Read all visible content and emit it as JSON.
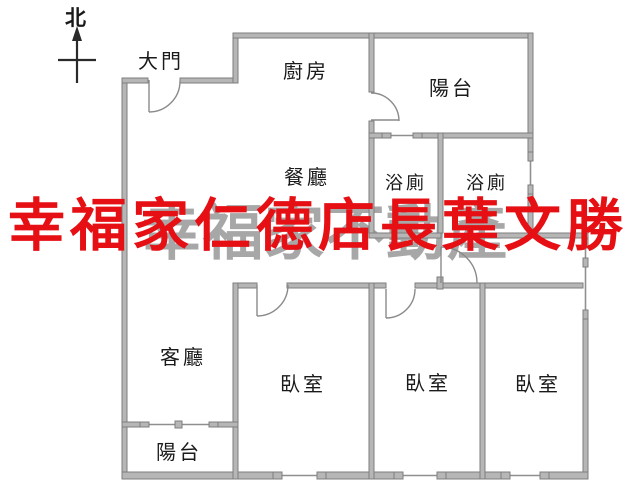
{
  "title": "apartment floor plan",
  "compass": {
    "label": "北"
  },
  "rooms": {
    "entrance": "大門",
    "kitchen": "廚房",
    "balcony_top": "陽台",
    "dining": "餐廳",
    "bath_left": "浴廁",
    "bath_right": "浴廁",
    "living": "客廳",
    "bedroom_left": "臥室",
    "bedroom_middle": "臥室",
    "bedroom_right": "臥室",
    "balcony_bottom": "陽台"
  },
  "watermarks": {
    "red_text": "幸福家仁德店長葉文勝",
    "red_color": "#e50f14",
    "gray_text": "幸福家不動產",
    "gray_color": "#a7a7a7"
  },
  "colors": {
    "background": "#ffffff",
    "wall_fill": "#b6b6b6",
    "wall_stroke": "#7e7e7e",
    "line": "#8a8a8a",
    "text": "#1a1a1a"
  }
}
